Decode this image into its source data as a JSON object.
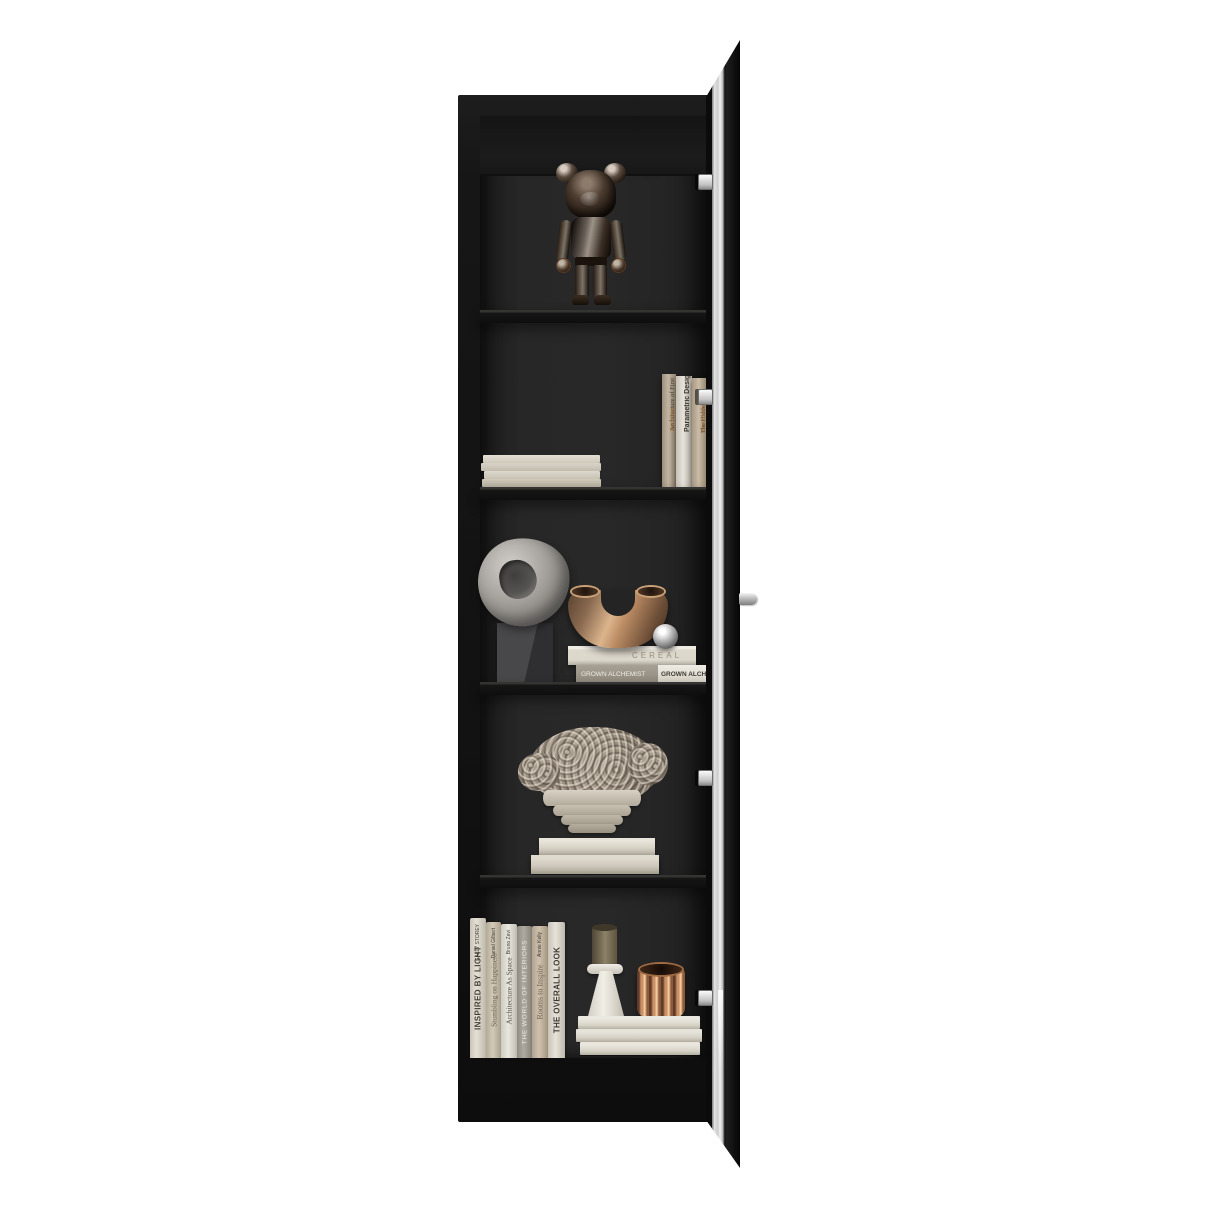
{
  "scene": {
    "background_color": "#ffffff",
    "furniture_color": "#161616",
    "interior_color": "#262626",
    "glass_color": "#d9d9d9",
    "hardware_color": "#d6d6d6",
    "bronze_color": "#bb8c64",
    "copper_color": "#c98f66",
    "stone_color": "#a9a6a1"
  },
  "objects": {
    "top_shelf": [
      "bearbrick-figure"
    ],
    "second_shelf": [
      "horizontal-book-stack",
      "vertical-book-trio"
    ],
    "middle_shelf": [
      "ring-sculpture",
      "cube-pedestal",
      "u-shaped-bronze-vase",
      "chrome-sphere",
      "book-stack"
    ],
    "fourth_shelf": [
      "dried-flower-bouquet",
      "tiered-stone-planter",
      "book-stack"
    ],
    "bottom_shelf": [
      "book-row",
      "candle-on-cone-holder",
      "fluted-copper-vessel",
      "board-stack"
    ]
  },
  "books": {
    "second_shelf": [
      {
        "title_main": "Architecture of First ",
        "title_accent": "Societies"
      },
      {
        "title_main": "Parametric Design",
        "title_accent": ""
      },
      {
        "title_main": "The Hidden ",
        "title_accent": "Dimension"
      }
    ],
    "middle_shelf": {
      "top_spine": "CEREAL",
      "bottom_spine": "GROWN ALCHEMIST",
      "bottom_edge": "GROWN ALCHEMIST"
    },
    "bottom_shelf": [
      {
        "title": "INSPIRED BY LIGHT",
        "author": "SALLY STOREY"
      },
      {
        "title": "Stumbling on Happiness",
        "author": "Daniel Gilbert"
      },
      {
        "title": "Architecture As Space",
        "author": "Bruno Zevi"
      },
      {
        "title": "THE WORLD OF INTERIORS",
        "author": ""
      },
      {
        "title": "Rooms to Inspire",
        "author": "Annie Kelly"
      },
      {
        "title": "THE OVERALL LOOK",
        "author": ""
      }
    ]
  }
}
